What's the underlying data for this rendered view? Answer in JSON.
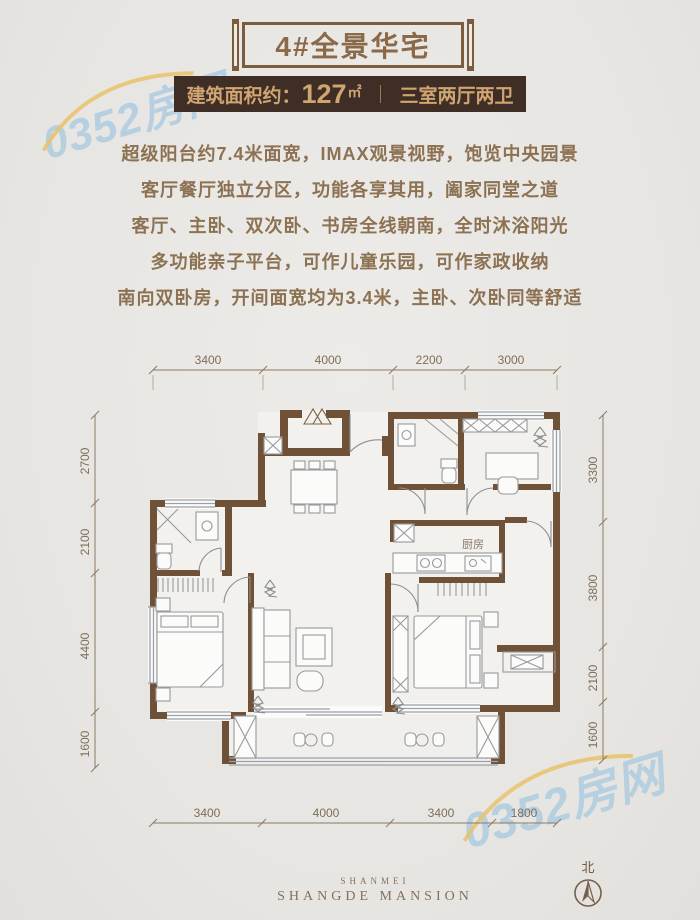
{
  "header": {
    "title": "4#全景华宅"
  },
  "area_banner": {
    "label": "建筑面积约：",
    "value": "127",
    "unit": "㎡",
    "divider": "｜",
    "layout": "三室两厅两卫",
    "bg": "#3e2e26",
    "fg": "#d0a571"
  },
  "description": {
    "lines": [
      "超级阳台约7.4米面宽，IMAX观景视野，饱览中央园景",
      "客厅餐厅独立分区，功能各享其用，阖家同堂之道",
      "客厅、主卧、双次卧、书房全线朝南，全时沐浴阳光",
      "多功能亲子平台，可作儿童乐园，可作家政收纳",
      "南向双卧房，开间面宽均为3.4米，主卧、次卧同等舒适"
    ]
  },
  "plan": {
    "room_labels": {
      "kitchen": "厨房"
    },
    "dims_top": [
      "3400",
      "4000",
      "2200",
      "3000"
    ],
    "dims_bottom": [
      "3400",
      "4000",
      "3400",
      "1800"
    ],
    "dims_left": [
      "2700",
      "2100",
      "4400",
      "1600"
    ],
    "dims_right": [
      "3300",
      "3800",
      "2100",
      "1600"
    ],
    "wall_color": "#6f5138",
    "furniture_color": "#98999b"
  },
  "watermark": {
    "text": "0352房网",
    "color": "#aacae0",
    "accent": "#e8c26a"
  },
  "footer": {
    "logo_top": "SHANMEI",
    "logo_main": "SHANGDE MANSION",
    "north_label": "北"
  }
}
